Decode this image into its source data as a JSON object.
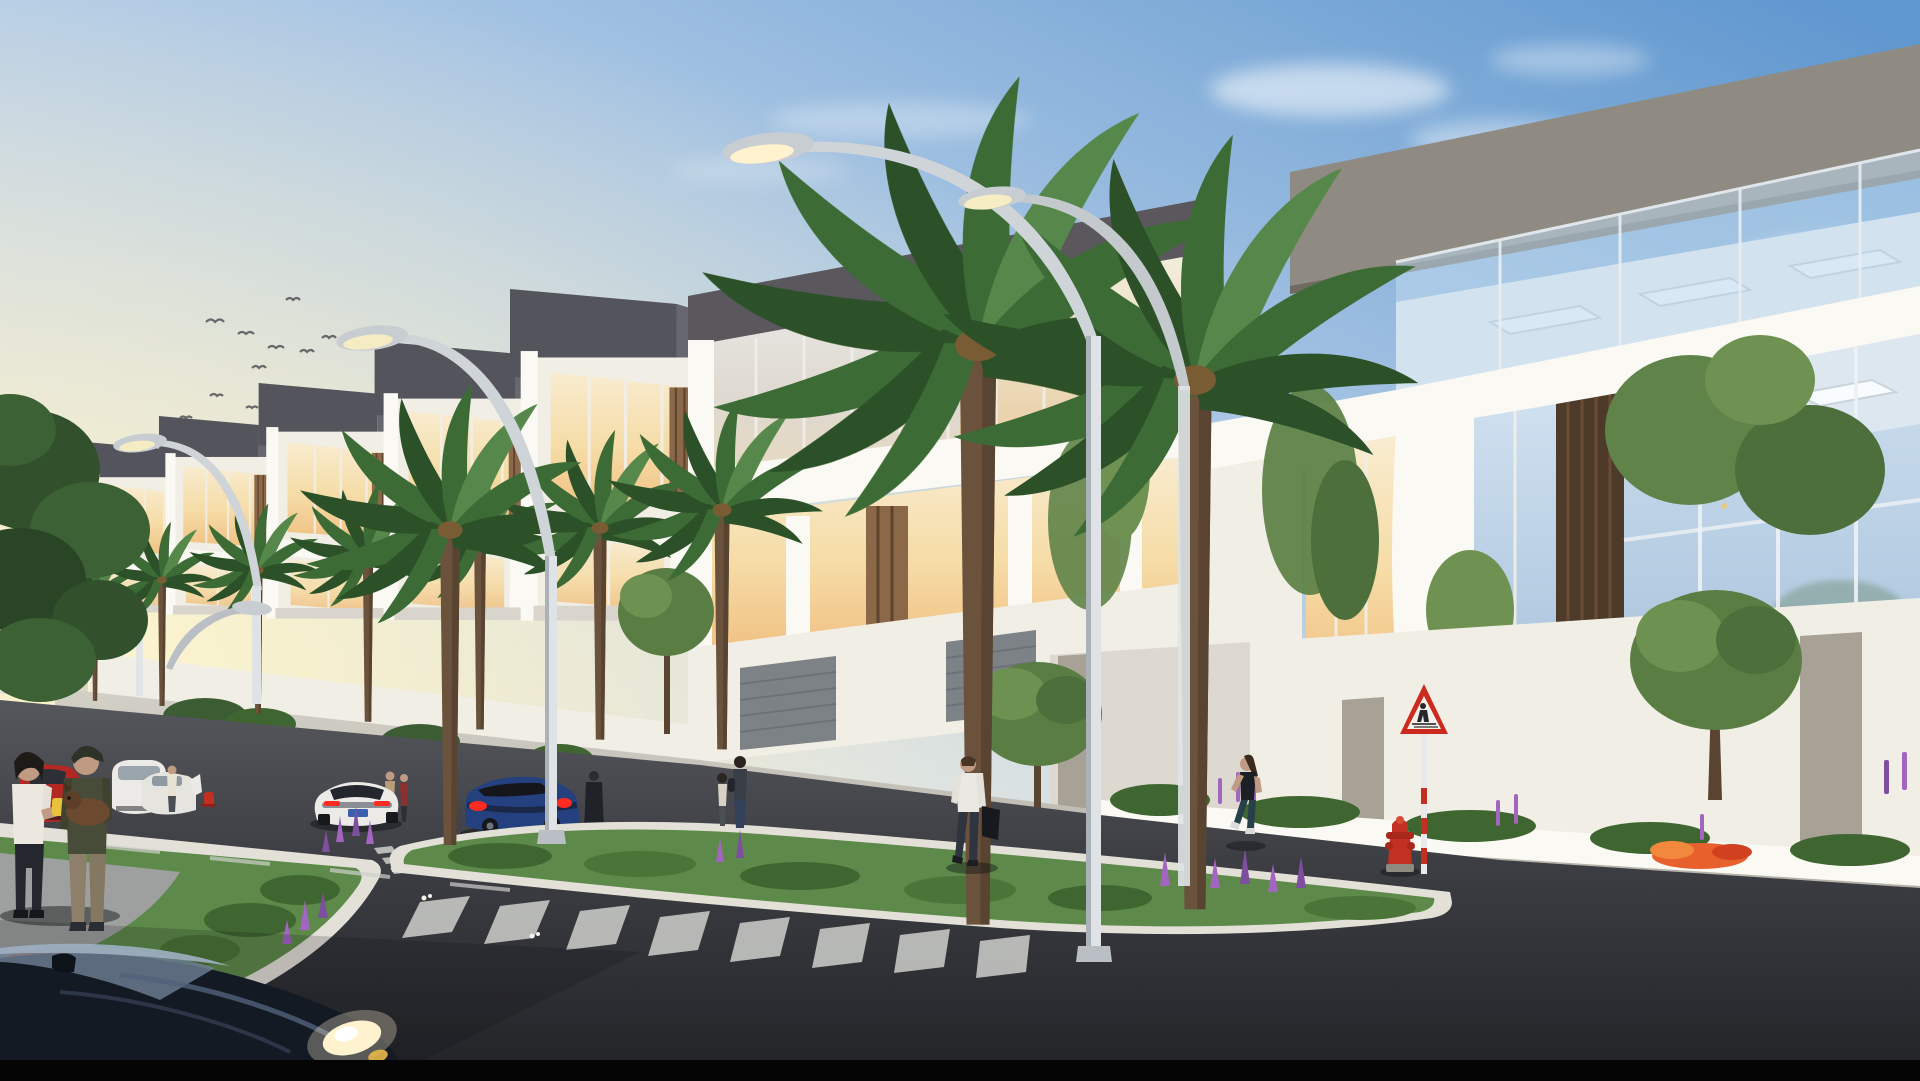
{
  "scene": {
    "description": "photorealistic dusk rendering of a modern townhouse street with palms",
    "time_of_day": "sunset",
    "camera": "street-level three-quarter view"
  },
  "palette": {
    "sky_zenith": "#5f97cf",
    "sky_mid": "#a9c6e4",
    "sky_horizon": "#f3ecd2",
    "sunset_glow": "#fbf0c4",
    "cloud_white": "#ffffff",
    "roof_charcoal": "#54555c",
    "parapet_gray": "#8f8b82",
    "wall_white": "#f1eee6",
    "glass_warm_top": "#f8ecd0",
    "glass_warm_bottom": "#f0c183",
    "glass_cool_top": "#cfe0ef",
    "glass_cool_bottom": "#a9c3dc",
    "wood_slat": "#8a6848",
    "palm_frond": "#3c6b35",
    "palm_trunk": "#6a523c",
    "grass_green": "#55843f",
    "flower_orange": "#e8602c",
    "flower_purple": "#a265c0",
    "road_top": "#55575c",
    "road_bottom": "#232529",
    "sidewalk": "#c9c6be",
    "lane_yellow": "#c9a23e",
    "crosswalk_white": "#d9dad6",
    "car_white": "#eceae6",
    "car_red": "#b22822",
    "car_blue": "#24407e",
    "car_foreground_dark": "#141a24",
    "tail_light_red": "#ff2a20",
    "headlight_warm": "#fff3cf",
    "hydrant_red": "#c23022",
    "sign_border_red": "#cc2a1e",
    "lamp_pole_gray": "#dfe3e6"
  },
  "sky": {
    "birds_count": 10,
    "clouds_right": true
  },
  "architecture": {
    "townhouse_units": 7,
    "corner_villa": 1,
    "features": [
      "charcoal roof volumes",
      "white stucco frames",
      "sunset-lit glazing",
      "wood slat accents",
      "glass roof balustrade",
      "compound walls with stone piers",
      "slatted garage gates"
    ]
  },
  "street": {
    "palms_count": 10,
    "street_lamps_count": 5,
    "deciduous_trees_count": 4,
    "fire_hydrants_count": 2,
    "signs": [
      {
        "type": "pedestrian-crossing-warning",
        "shape": "red-bordered triangle"
      }
    ],
    "crosswalk_stripes": 8,
    "median": {
      "planting": [
        "lawn grass",
        "orange flower clusters",
        "purple lupines",
        "ornamental grasses"
      ]
    }
  },
  "vehicles": [
    {
      "type": "foreground sedan hood",
      "color": "dark navy",
      "detail": "headlight lit"
    },
    {
      "type": "sports car rear",
      "color": "white",
      "detail": "tail lights lit"
    },
    {
      "type": "sedan",
      "color": "dark blue",
      "detail": "tail lights lit"
    },
    {
      "type": "hatchback",
      "color": "red"
    },
    {
      "type": "minivan",
      "color": "white"
    },
    {
      "type": "sedan with open door",
      "color": "white"
    }
  ],
  "pedestrians": [
    {
      "who": "woman with drink",
      "where": "left median"
    },
    {
      "who": "man holding small dog",
      "where": "left median"
    },
    {
      "who": "woman and child",
      "where": "far sidewalk"
    },
    {
      "who": "man with duffel bag",
      "where": "crossing street"
    },
    {
      "who": "female jogger",
      "where": "right sidewalk"
    },
    {
      "who": "woman at open car door",
      "where": "far parking lane"
    },
    {
      "who": "two residents",
      "where": "by garage gates"
    },
    {
      "who": "robed figure",
      "where": "by compound wall"
    }
  ]
}
